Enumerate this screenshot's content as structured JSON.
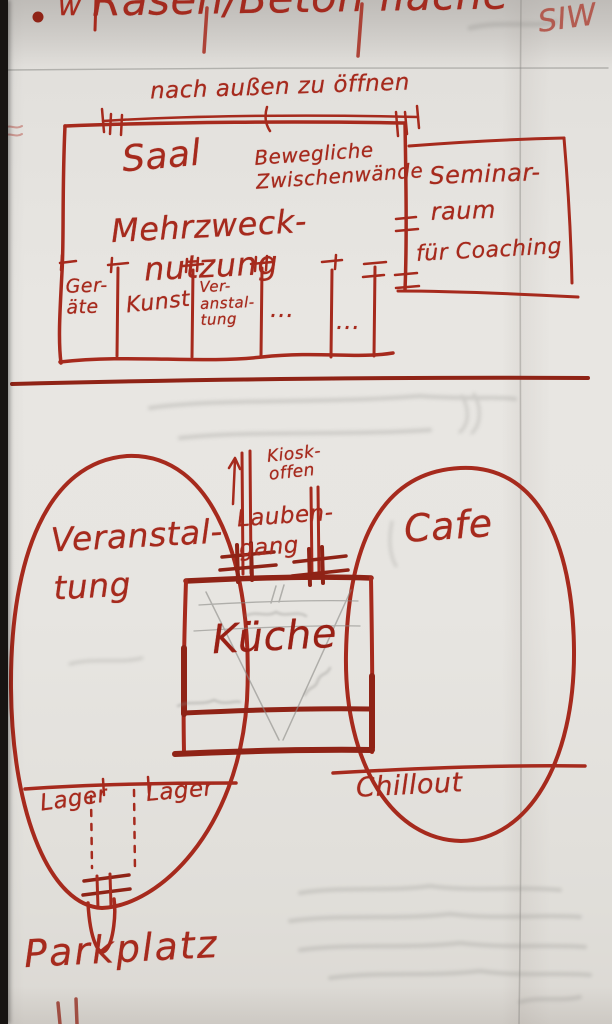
{
  "colors": {
    "marker_red": "#a62a1d",
    "marker_dark": "#8f2316",
    "pencil_gray": "#8b8a86",
    "paper": "#e8e6e2"
  },
  "header": {
    "title_fragment": "Rasen/Beton fläche",
    "left_edge_fragment": "w",
    "corner_scribble": "SIW"
  },
  "upper_plan": {
    "open_outward_note": "nach außen zu öffnen",
    "hall_name": "Saal",
    "partition_note": "Bewegliche\nZwischenwände",
    "hall_usage": "Mehrzweck-\nnutzung",
    "seminar_room_name": "Seminar-\nraum",
    "seminar_room_purpose": "für Coaching",
    "rooms": [
      {
        "label": "Ger-\näte"
      },
      {
        "label": "Kunst"
      },
      {
        "label": "Ver-\nanstal-\ntung"
      },
      {
        "label": "..."
      },
      {
        "label": "..."
      }
    ]
  },
  "lower_plan": {
    "left_area_label": "Veranstal-\ntung",
    "right_area_label": "Cafe",
    "kitchen_label": "Küche",
    "kiosk_note": "Kiosk-\noffen",
    "walkway_label": "Lauben-\ngang",
    "storage_labels": [
      "Lager",
      "Lager"
    ],
    "chillout_label": "Chillout",
    "parking_label": "Parkplatz"
  }
}
